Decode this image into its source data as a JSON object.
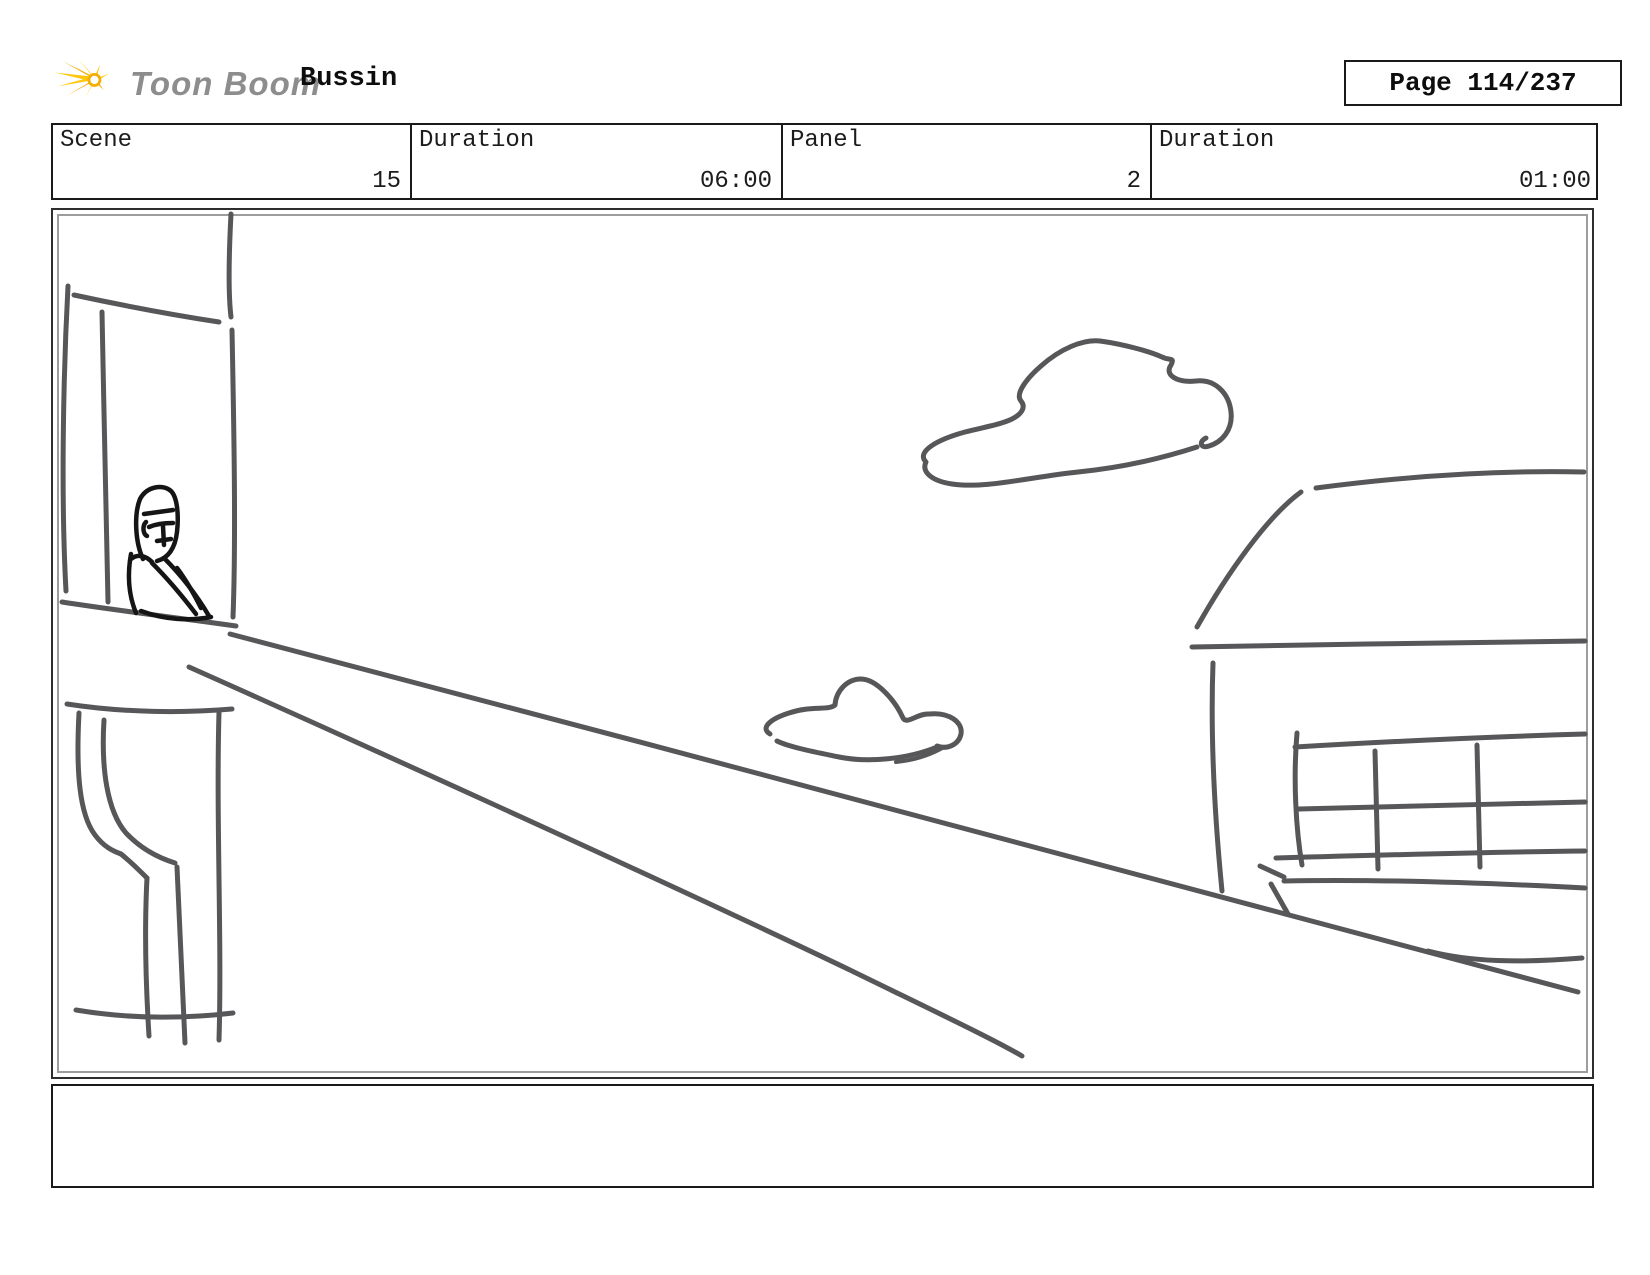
{
  "page": {
    "logo_text": "Toon Boom",
    "title": "Bussin",
    "page_label": "Page 114/237"
  },
  "meta": {
    "cells": [
      {
        "label": "Scene",
        "value": "15"
      },
      {
        "label": "Duration",
        "value": "06:00"
      },
      {
        "label": "Panel",
        "value": "2"
      },
      {
        "label": "Duration",
        "value": "01:00"
      }
    ]
  },
  "panel": {
    "alt": "Hand-drawn storyboard sketch: a person leaning at a window ledge on the left, a street receding in perspective to the lower right, two clouds in the sky, and a building with a long window grid on the right."
  },
  "caption": {
    "text": ""
  },
  "colors": {
    "sketch_stroke": "#57575a",
    "figure_stroke": "#151515",
    "logo_yellow": "#ffc60b",
    "logo_orange": "#f7a600",
    "logo_gray": "#8d8d8d",
    "border_dark": "#1a1a1a",
    "border_inner_gray": "#9d9d9d"
  }
}
